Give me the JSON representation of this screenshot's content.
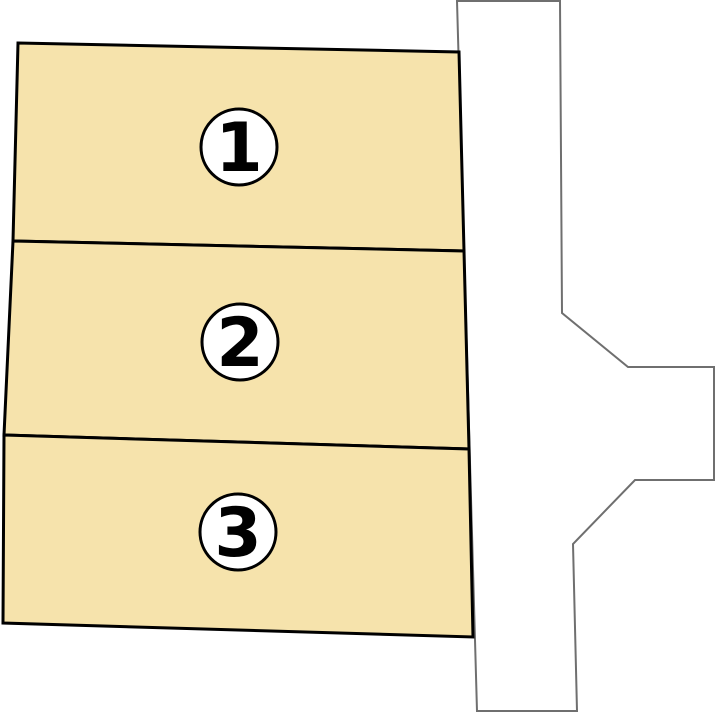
{
  "canvas": {
    "width": 715,
    "height": 712,
    "background": "#ffffff"
  },
  "palette": {
    "parcel_fill": "#f6e3ac",
    "parcel_stroke": "#000000",
    "parcel_stroke_width": 3,
    "road_fill": "#ffffff",
    "road_stroke": "#6f6f6f",
    "road_stroke_width": 2,
    "badge_fill": "#ffffff",
    "badge_stroke": "#000000",
    "badge_stroke_width": 3,
    "number_color": "#000000"
  },
  "road": {
    "name": "road",
    "points": [
      [
        457,
        1
      ],
      [
        560,
        1
      ],
      [
        562,
        313
      ],
      [
        628,
        367
      ],
      [
        714,
        367
      ],
      [
        714,
        480
      ],
      [
        635,
        480
      ],
      [
        573,
        544
      ],
      [
        577,
        711
      ],
      [
        477,
        711
      ]
    ]
  },
  "parcels": [
    {
      "label": "1",
      "points": [
        [
          18,
          43
        ],
        [
          459,
          52
        ],
        [
          464,
          251
        ],
        [
          13,
          241
        ]
      ],
      "badge": {
        "cx": 239,
        "cy": 147,
        "r": 38
      }
    },
    {
      "label": "2",
      "points": [
        [
          13,
          241
        ],
        [
          464,
          251
        ],
        [
          469,
          449
        ],
        [
          4,
          435
        ]
      ],
      "badge": {
        "cx": 240,
        "cy": 342,
        "r": 38
      }
    },
    {
      "label": "3",
      "points": [
        [
          4,
          435
        ],
        [
          469,
          449
        ],
        [
          473,
          637
        ],
        [
          3,
          623
        ]
      ],
      "badge": {
        "cx": 238,
        "cy": 532,
        "r": 38
      }
    }
  ]
}
